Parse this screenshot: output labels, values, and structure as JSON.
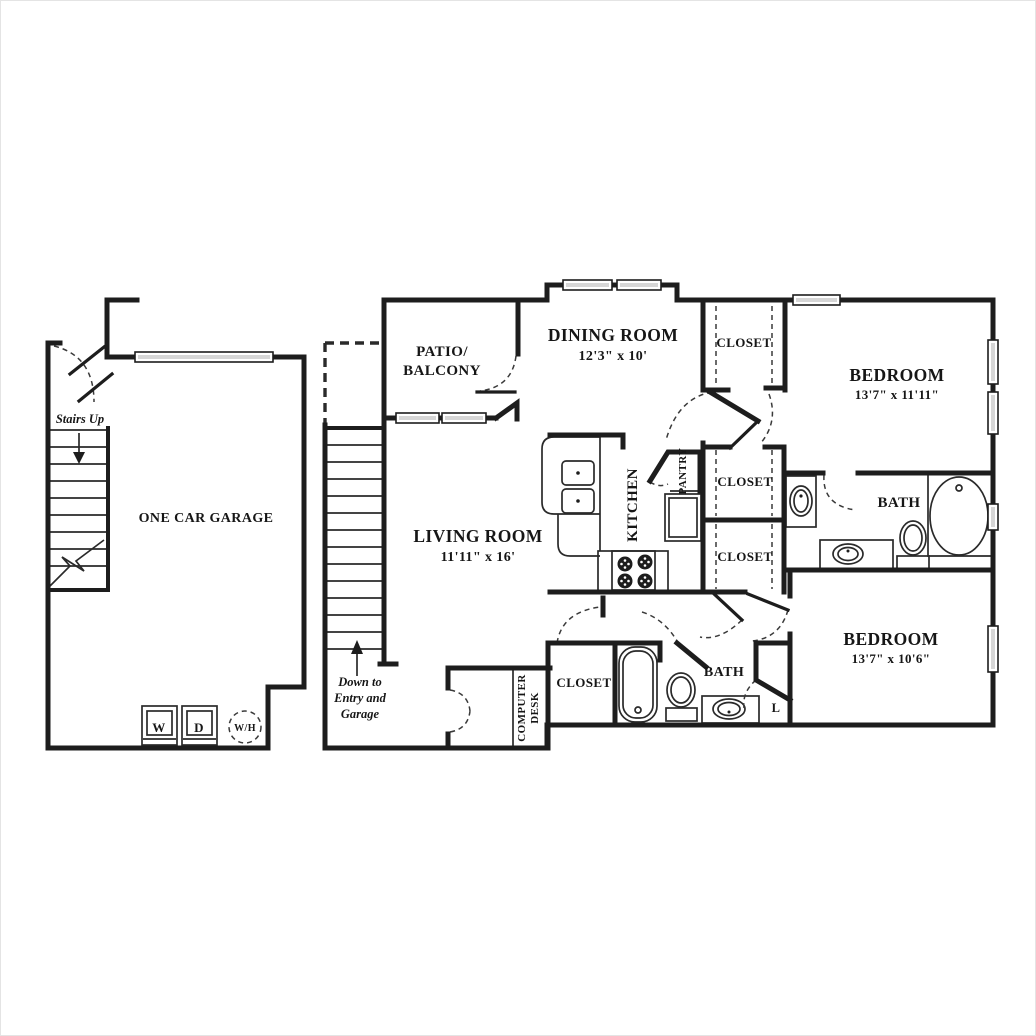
{
  "plan_title": "Two Bedroom Townhome Floor Plan",
  "colors": {
    "ink": "#1d1d1d",
    "background": "#ffffff",
    "window_fill": "#d6d6d6"
  },
  "garage": {
    "name": "ONE CAR GARAGE",
    "stairs_up": "Stairs Up",
    "washer": "W",
    "dryer": "D",
    "water_heater": "W/H"
  },
  "patio": {
    "line1": "PATIO/",
    "line2": "BALCONY"
  },
  "living_room": {
    "name": "LIVING ROOM",
    "dims": "11'11\" x 16'"
  },
  "dining_room": {
    "name": "DINING ROOM",
    "dims": "12'3\" x 10'"
  },
  "kitchen": {
    "name": "KITCHEN",
    "pantry": "PANTRY"
  },
  "stairs_note": {
    "line1": "Down to",
    "line2": "Entry and",
    "line3": "Garage"
  },
  "computer_desk": {
    "line1": "COMPUTER",
    "line2": "DESK"
  },
  "closets": {
    "entry_hall": "CLOSET",
    "hall_upper": "CLOSET",
    "hall_lower": "CLOSET",
    "bedroom2_closet": "CLOSET",
    "linen": "L"
  },
  "bedroom1": {
    "name": "BEDROOM",
    "dims": "13'7\" x 11'11\""
  },
  "bedroom2": {
    "name": "BEDROOM",
    "dims": "13'7\" x 10'6\""
  },
  "bath1": {
    "name": "BATH"
  },
  "bath2": {
    "name": "BATH"
  }
}
